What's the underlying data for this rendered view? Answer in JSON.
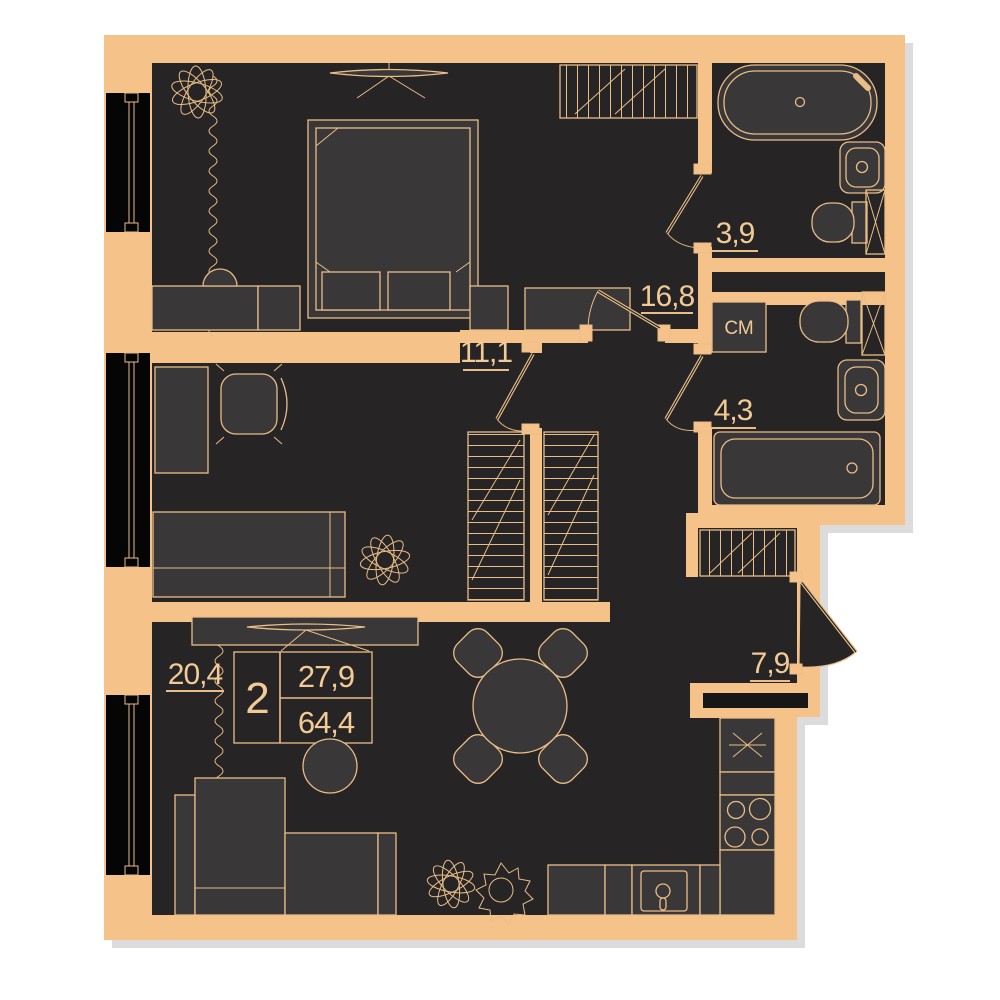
{
  "floorplan": {
    "info_box": {
      "rooms_count": "2",
      "living_area": "27,9",
      "total_area": "64,4"
    },
    "room_labels": {
      "bedroom": "16,8",
      "study": "11,1",
      "living_room": "20,4",
      "bathroom_top": "3,9",
      "bathroom_mid": "4,3",
      "kitchen": "7,9"
    },
    "appliance_labels": {
      "washing_machine": "СМ"
    },
    "colors": {
      "wall": "#f5c28a",
      "floor": "#262424",
      "furniture": "#393737",
      "outline": "#e9bd87",
      "text": "#f2ca96",
      "window": "#050505",
      "shadow": "#dcdcdc",
      "background": "#ffffff"
    }
  }
}
